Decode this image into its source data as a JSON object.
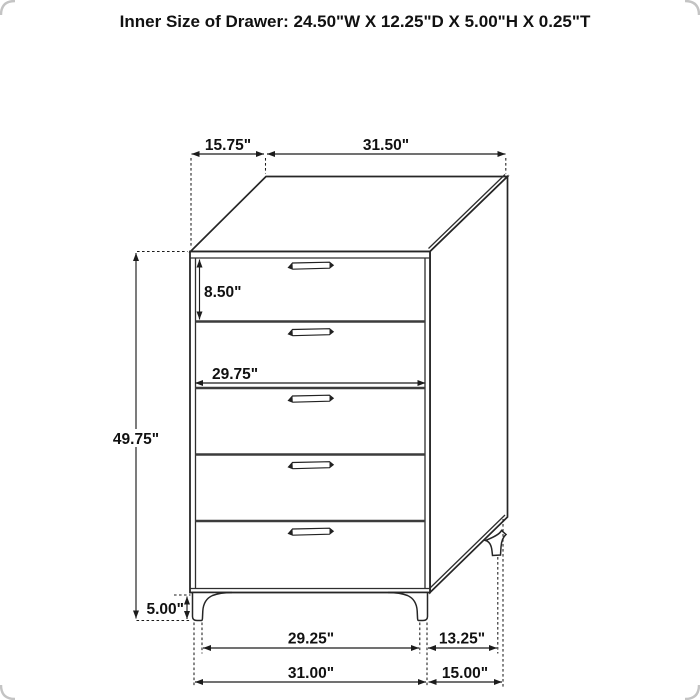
{
  "title": "Inner Size of Drawer: 24.50\"W X 12.25\"D X 5.00\"H X 0.25\"T",
  "inner_drawer_size": {
    "width": "24.50\"W",
    "depth": "12.25\"D",
    "height": "5.00\"H",
    "thickness": "0.25\"T"
  },
  "furniture": {
    "type": "5-drawer chest",
    "drawer_count": 5
  },
  "dimension_labels": {
    "top_depth": "15.75\"",
    "top_width": "31.50\"",
    "top_drawer_height": "8.50\"",
    "drawer_front_width": "29.75\"",
    "case_height": "49.75\"",
    "leg_height": "5.00\"",
    "front_leg_span": "29.25\"",
    "side_leg_span": "13.25\"",
    "overall_width": "31.00\"",
    "overall_depth": "15.00\""
  },
  "colors": {
    "background": "#ffffff",
    "outline": "#262626",
    "divider": "#3c3c3c",
    "dimension_line": "#1c1c1c",
    "text": "#111111",
    "corner_frame": "#c4c4c4"
  }
}
